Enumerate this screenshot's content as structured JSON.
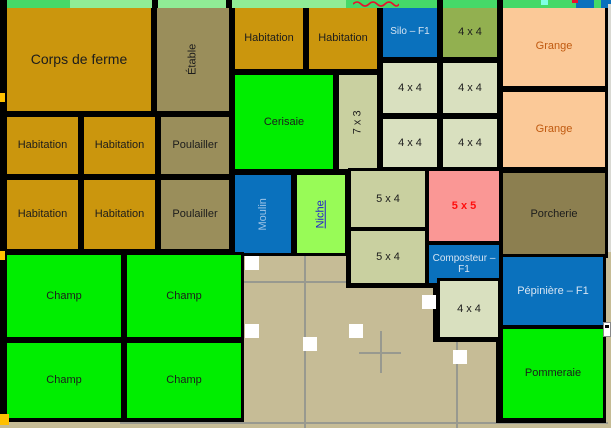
{
  "palette": {
    "gold": "#CB960D",
    "khaki": "#9A8E5B",
    "dark_olive": "#8C7F50",
    "olive_green": "#92B050",
    "pale_green": "#D9E0BF",
    "sage": "#C9D0A0",
    "bright_green": "#00EE00",
    "light_green": "#98FB57",
    "blue": "#0A71BD",
    "peach": "#FBC998",
    "pink": "#FA9795",
    "beige": "#C6BC96",
    "grid_gray": "#98998F",
    "label_dark": "#1C1C1C",
    "label_light_blue": "#D6E4F2",
    "moulin_text": "#9DC3E6",
    "grange_text": "#C05A10",
    "red": "#FF0E0E",
    "niche_text": "#2121CC",
    "notch_yellow": "#FFC000",
    "sliver_gray": "#D9D9D3"
  },
  "map": {
    "width": 611,
    "height": 428,
    "background": "#C6BC96",
    "top_strip": {
      "height": 8,
      "base_color": "#45D968",
      "light_segment": {
        "x": 70,
        "w": 276,
        "color": "#90EC95"
      },
      "black_ticks": [
        152,
        226,
        437,
        497
      ],
      "squiggle": {
        "x": 353,
        "w": 46,
        "color": "#E8112D"
      },
      "red_dot": {
        "x": 572,
        "w": 6,
        "color": "#E8112D"
      },
      "cyan_tick": {
        "x": 541,
        "w": 7,
        "color": "#7FFFE6"
      },
      "blue_segments": [
        {
          "x": 576,
          "w": 18
        },
        {
          "x": 601,
          "w": 10
        }
      ]
    },
    "left_border": {
      "w": 7,
      "h": 421,
      "notches": [
        {
          "y": 93
        },
        {
          "y": 251
        }
      ],
      "notch_h": 9,
      "bottom_mark": {
        "x": 0,
        "y": 414,
        "w": 9,
        "h": 11
      }
    },
    "right_sliver": {
      "x": 608,
      "y": 4,
      "w": 3,
      "h": 248
    },
    "edge_widget": {
      "x": 603,
      "y": 322,
      "w": 8,
      "h": 15
    },
    "backings": [
      [
        4,
        4,
        604,
        250
      ],
      [
        4,
        250,
        240,
        172
      ],
      [
        346,
        166,
        158,
        122
      ],
      [
        496,
        250,
        110,
        173
      ],
      [
        433,
        276,
        70,
        66
      ]
    ],
    "canvas": {
      "v_lines": [
        {
          "x": 304,
          "y": 250,
          "h": 178
        },
        {
          "x": 456,
          "y": 252,
          "h": 176
        }
      ],
      "h_lines": [
        {
          "y": 281,
          "x": 236,
          "w": 266
        },
        {
          "y": 422,
          "x": 120,
          "w": 488
        }
      ],
      "white_squares": [
        {
          "x": 245,
          "y": 256
        },
        {
          "x": 245,
          "y": 324
        },
        {
          "x": 303,
          "y": 337
        },
        {
          "x": 349,
          "y": 324
        },
        {
          "x": 422,
          "y": 295
        },
        {
          "x": 453,
          "y": 350
        }
      ],
      "square_size": 14,
      "crosshair": {
        "x": 380,
        "y": 352,
        "arm": 21
      }
    },
    "blocks": [
      {
        "id": "corps-de-ferme",
        "label": "Corps de ferme",
        "x": 4,
        "y": 4,
        "w": 150,
        "h": 110,
        "bg": "gold",
        "fs": 14
      },
      {
        "id": "etable",
        "label": "Étable",
        "x": 154,
        "y": 4,
        "w": 78,
        "h": 110,
        "bg": "khaki",
        "v": true
      },
      {
        "id": "habitation-1",
        "label": "Habitation",
        "x": 232,
        "y": 4,
        "w": 74,
        "h": 68,
        "bg": "gold"
      },
      {
        "id": "habitation-2",
        "label": "Habitation",
        "x": 306,
        "y": 4,
        "w": 74,
        "h": 68,
        "bg": "gold"
      },
      {
        "id": "silo-f1",
        "label": "Silo – F1",
        "x": 380,
        "y": 4,
        "w": 60,
        "h": 56,
        "bg": "blue",
        "fg": "label_light_blue",
        "fs": 10
      },
      {
        "id": "4x4-olive",
        "label": "4 x 4",
        "x": 440,
        "y": 4,
        "w": 60,
        "h": 56,
        "bg": "olive_green"
      },
      {
        "id": "grange-1",
        "label": "Grange",
        "x": 500,
        "y": 4,
        "w": 108,
        "h": 85,
        "bg": "peach",
        "fg": "grange_text"
      },
      {
        "id": "grange-2",
        "label": "Grange",
        "x": 500,
        "y": 89,
        "w": 108,
        "h": 81,
        "bg": "peach",
        "fg": "grange_text"
      },
      {
        "id": "cerisaie",
        "label": "Cerisaie",
        "x": 232,
        "y": 72,
        "w": 104,
        "h": 100,
        "bg": "bright_green"
      },
      {
        "id": "7x3",
        "label": "7 x 3",
        "x": 336,
        "y": 72,
        "w": 44,
        "h": 100,
        "bg": "sage",
        "v": true
      },
      {
        "id": "4x4-a",
        "label": "4 x 4",
        "x": 380,
        "y": 60,
        "w": 60,
        "h": 56,
        "bg": "pale_green"
      },
      {
        "id": "4x4-b",
        "label": "4 x 4",
        "x": 440,
        "y": 60,
        "w": 60,
        "h": 56,
        "bg": "pale_green"
      },
      {
        "id": "4x4-c",
        "label": "4 x 4",
        "x": 380,
        "y": 116,
        "w": 60,
        "h": 54,
        "bg": "pale_green"
      },
      {
        "id": "4x4-d",
        "label": "4 x 4",
        "x": 440,
        "y": 116,
        "w": 60,
        "h": 54,
        "bg": "pale_green"
      },
      {
        "id": "habitation-3",
        "label": "Habitation",
        "x": 4,
        "y": 114,
        "w": 77,
        "h": 63,
        "bg": "gold"
      },
      {
        "id": "habitation-4",
        "label": "Habitation",
        "x": 81,
        "y": 114,
        "w": 77,
        "h": 63,
        "bg": "gold"
      },
      {
        "id": "poulailler-1",
        "label": "Poulailler",
        "x": 158,
        "y": 114,
        "w": 74,
        "h": 63,
        "bg": "khaki"
      },
      {
        "id": "habitation-5",
        "label": "Habitation",
        "x": 4,
        "y": 177,
        "w": 77,
        "h": 75,
        "bg": "gold"
      },
      {
        "id": "habitation-6",
        "label": "Habitation",
        "x": 81,
        "y": 177,
        "w": 77,
        "h": 75,
        "bg": "gold"
      },
      {
        "id": "poulailler-2",
        "label": "Poulailler",
        "x": 158,
        "y": 177,
        "w": 74,
        "h": 75,
        "bg": "khaki"
      },
      {
        "id": "moulin",
        "label": "Moulin",
        "x": 232,
        "y": 172,
        "w": 62,
        "h": 84,
        "bg": "blue",
        "fg": "moulin_text",
        "v": true
      },
      {
        "id": "niche",
        "label": "Niche",
        "x": 294,
        "y": 172,
        "w": 54,
        "h": 84,
        "bg": "light_green",
        "fg": "niche_text",
        "v": true,
        "underline": true
      },
      {
        "id": "5x4-a",
        "label": "5 x 4",
        "x": 348,
        "y": 168,
        "w": 80,
        "h": 62,
        "bg": "sage"
      },
      {
        "id": "5x4-b",
        "label": "5 x 4",
        "x": 348,
        "y": 228,
        "w": 80,
        "h": 58,
        "bg": "sage"
      },
      {
        "id": "5x5",
        "label": "5 x 5",
        "x": 426,
        "y": 168,
        "w": 76,
        "h": 76,
        "bg": "pink",
        "fg": "red",
        "bold": true
      },
      {
        "id": "composteur-f1",
        "label": "Composteur –",
        "label2": "F1",
        "x": 426,
        "y": 242,
        "w": 76,
        "h": 44,
        "bg": "blue",
        "fg": "label_light_blue",
        "fs": 10
      },
      {
        "id": "porcherie",
        "label": "Porcherie",
        "x": 500,
        "y": 170,
        "w": 108,
        "h": 88,
        "bg": "dark_olive"
      },
      {
        "id": "pepiniere-f1",
        "label": "Pépinière – F1",
        "x": 500,
        "y": 254,
        "w": 106,
        "h": 74,
        "bg": "blue",
        "fg": "label_light_blue"
      },
      {
        "id": "champ-1",
        "label": "Champ",
        "x": 4,
        "y": 252,
        "w": 120,
        "h": 88,
        "bg": "bright_green"
      },
      {
        "id": "champ-2",
        "label": "Champ",
        "x": 124,
        "y": 252,
        "w": 120,
        "h": 88,
        "bg": "bright_green"
      },
      {
        "id": "champ-3",
        "label": "Champ",
        "x": 4,
        "y": 340,
        "w": 120,
        "h": 81,
        "bg": "bright_green"
      },
      {
        "id": "champ-4",
        "label": "Champ",
        "x": 124,
        "y": 340,
        "w": 120,
        "h": 81,
        "bg": "bright_green"
      },
      {
        "id": "4x4-bottom",
        "label": "4 x 4",
        "x": 437,
        "y": 278,
        "w": 64,
        "h": 62,
        "bg": "pale_green"
      },
      {
        "id": "pommeraie",
        "label": "Pommeraie",
        "x": 500,
        "y": 326,
        "w": 106,
        "h": 95,
        "bg": "bright_green"
      }
    ]
  }
}
